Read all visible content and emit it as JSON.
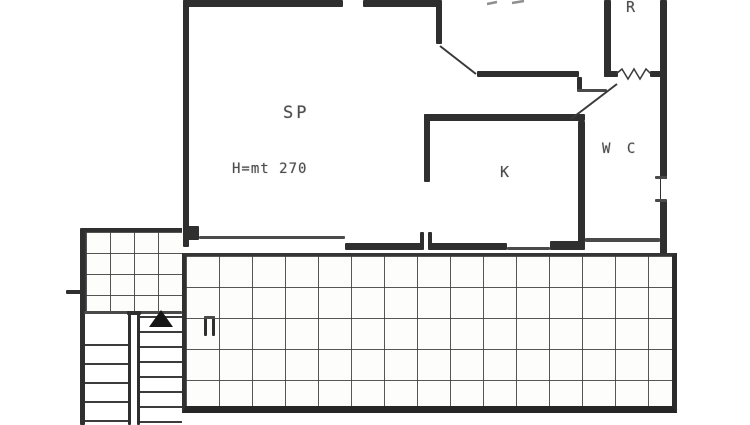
{
  "document": {
    "kind": "scanned apartment floor plan",
    "paper_color": "#ffffff",
    "ink_color": "#2f2f2f",
    "grid_color": "#3c3c3c",
    "text_color": "#4c4c4c"
  },
  "rooms": [
    {
      "name": "living-room",
      "label": "SP"
    },
    {
      "name": "kitchen",
      "label": "K"
    },
    {
      "name": "wc",
      "label": "W C"
    },
    {
      "name": "storage",
      "label": "R"
    }
  ],
  "annotations": [
    {
      "name": "ceiling-height",
      "text": "H=mt 270"
    }
  ],
  "symbols": [
    {
      "name": "stair-direction-arrow",
      "shape": "filled-triangle-up"
    },
    {
      "name": "door-swing",
      "count": 2
    },
    {
      "name": "window-zigzag",
      "shape": "zigzag"
    },
    {
      "name": "floor-tile-grid",
      "areas": [
        "terrace",
        "stair-landing"
      ]
    }
  ]
}
